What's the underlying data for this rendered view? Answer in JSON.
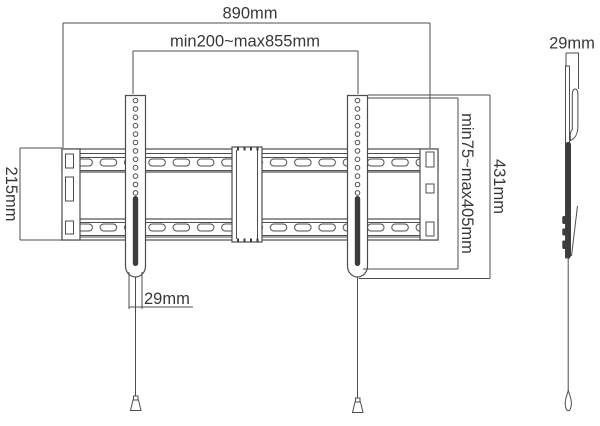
{
  "colors": {
    "line_color": "#4d4d4d",
    "dark_fill": "#3c3c3c",
    "text_color": "#383838",
    "background": "#ffffff"
  },
  "dimensions": {
    "total_width": "890mm",
    "mount_width_range": "min200~max855mm",
    "wall_plate_height": "215mm",
    "vesa_height_range": "min75~max405mm",
    "bracket_total_height": "431mm",
    "arm_width": "29mm",
    "side_profile_depth": "29mm"
  }
}
